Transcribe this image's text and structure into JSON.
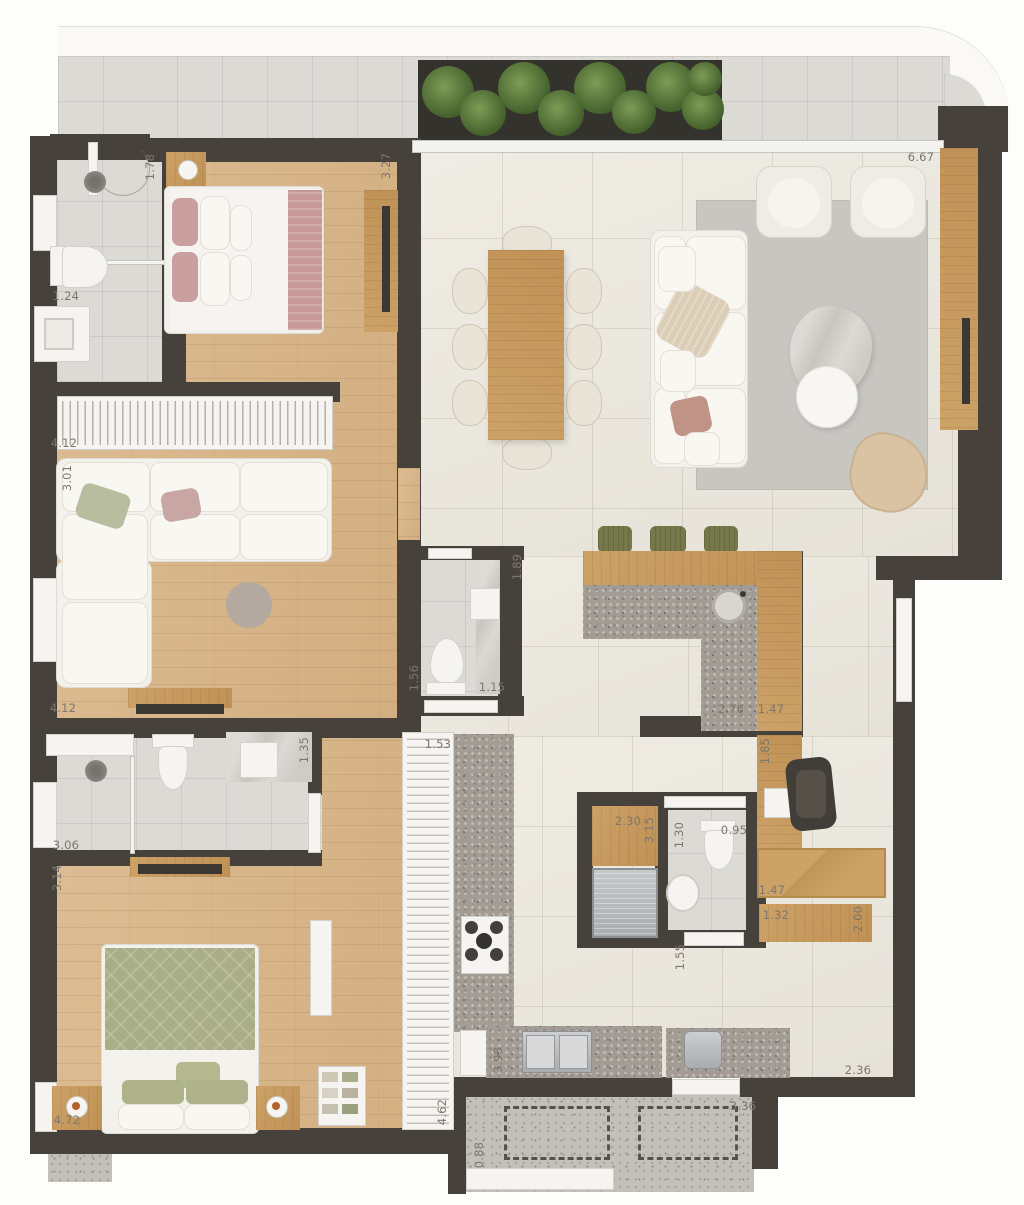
{
  "plan_type": "apartment-floor-plan",
  "colors": {
    "wall": "#47413b",
    "wood_floor": "#d7b588",
    "wood_cabinet": "#c79a5e",
    "tile_light": "#ece8e0",
    "bath_tile": "#dcdad5",
    "granite": "#a29c95",
    "terrazzo": "#c3c0ba",
    "white_fixture": "#f5f4f0",
    "rug": "#c8c6c1",
    "plant_green": "#4c6a34",
    "stool_green": "#75794a",
    "pillow_pink": "#c6a0a0",
    "bed_green": "#a9ae86",
    "chair_tan": "#d9c3a2",
    "marble": "#d3d0cb",
    "label_text": "#7c766e"
  },
  "labels": [
    {
      "text": "1.78",
      "x": 150,
      "y": 167,
      "v": true
    },
    {
      "text": "1.24",
      "x": 66,
      "y": 296,
      "v": false
    },
    {
      "text": "3.27",
      "x": 386,
      "y": 166,
      "v": true
    },
    {
      "text": "6.67",
      "x": 921,
      "y": 157,
      "v": false
    },
    {
      "text": "4.12",
      "x": 64,
      "y": 443,
      "v": false
    },
    {
      "text": "3.01",
      "x": 67,
      "y": 478,
      "v": true
    },
    {
      "text": "1.89",
      "x": 517,
      "y": 567,
      "v": true
    },
    {
      "text": "1.56",
      "x": 414,
      "y": 678,
      "v": true
    },
    {
      "text": "1.15",
      "x": 492,
      "y": 687,
      "v": false
    },
    {
      "text": "2.76",
      "x": 731,
      "y": 709,
      "v": false
    },
    {
      "text": "1.47",
      "x": 771,
      "y": 709,
      "v": false
    },
    {
      "text": "4.12",
      "x": 63,
      "y": 708,
      "v": false
    },
    {
      "text": "1.35",
      "x": 304,
      "y": 750,
      "v": true
    },
    {
      "text": "1.53",
      "x": 438,
      "y": 744,
      "v": false
    },
    {
      "text": "3.06",
      "x": 66,
      "y": 845,
      "v": false
    },
    {
      "text": "3.14",
      "x": 57,
      "y": 878,
      "v": true
    },
    {
      "text": "2.30",
      "x": 628,
      "y": 821,
      "v": false
    },
    {
      "text": "3.15",
      "x": 649,
      "y": 830,
      "v": true
    },
    {
      "text": "1.30",
      "x": 679,
      "y": 835,
      "v": true
    },
    {
      "text": "0.95",
      "x": 734,
      "y": 830,
      "v": false
    },
    {
      "text": "1.85",
      "x": 765,
      "y": 751,
      "v": true
    },
    {
      "text": "1.47",
      "x": 772,
      "y": 890,
      "v": false
    },
    {
      "text": "1.32",
      "x": 776,
      "y": 915,
      "v": false
    },
    {
      "text": "2.00",
      "x": 858,
      "y": 919,
      "v": true
    },
    {
      "text": "1.55",
      "x": 680,
      "y": 957,
      "v": true
    },
    {
      "text": "4.72",
      "x": 67,
      "y": 1120,
      "v": false
    },
    {
      "text": "4.62",
      "x": 442,
      "y": 1112,
      "v": true
    },
    {
      "text": "3.98",
      "x": 498,
      "y": 1060,
      "v": true
    },
    {
      "text": "0.88",
      "x": 479,
      "y": 1155,
      "v": true
    },
    {
      "text": "3.36",
      "x": 743,
      "y": 1106,
      "v": false
    },
    {
      "text": "2.36",
      "x": 858,
      "y": 1070,
      "v": false
    }
  ]
}
